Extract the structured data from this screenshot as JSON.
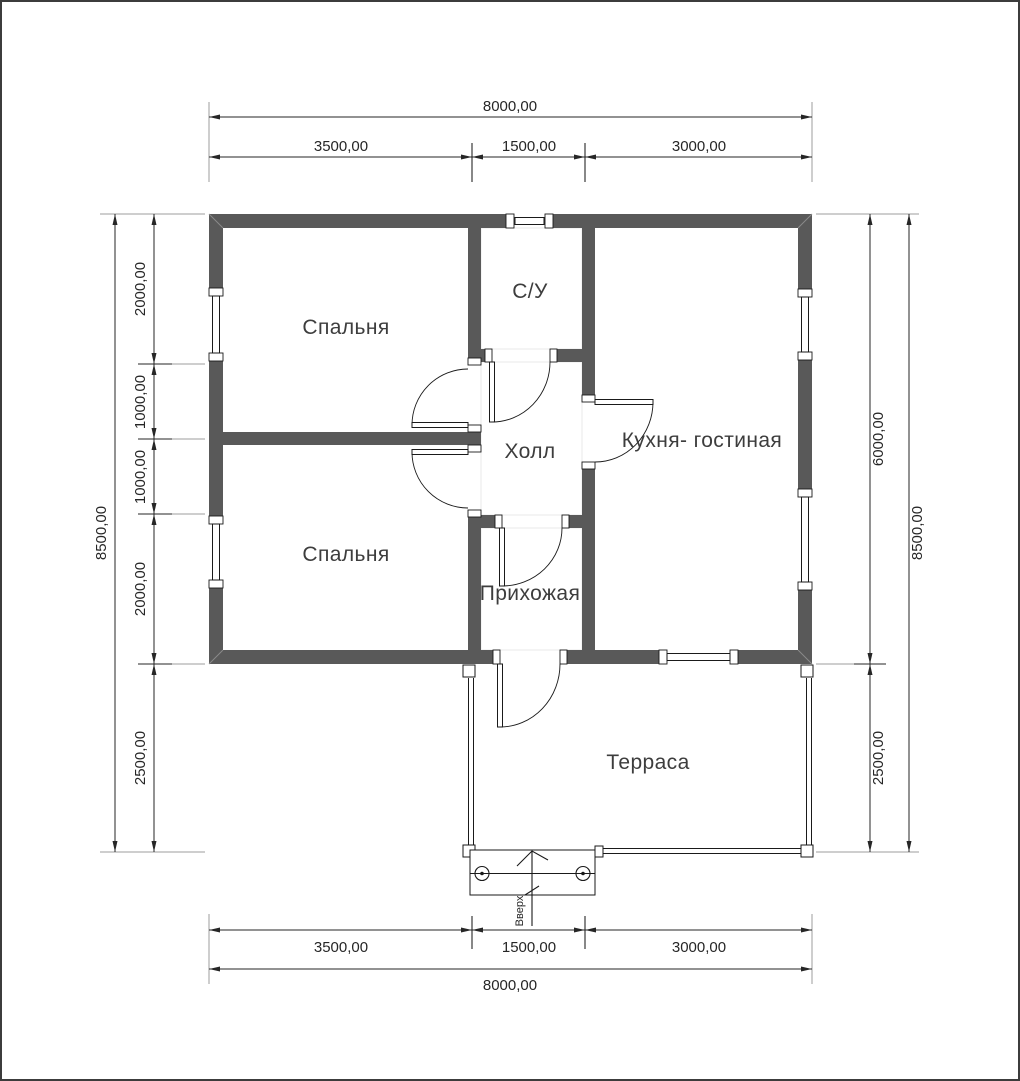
{
  "title": "Floor plan",
  "colors": {
    "wall": "#595959",
    "line": "#1a1a1a",
    "dim_text": "#262626",
    "room_text": "#3d3d3d",
    "witness": "#9d9d9d",
    "background": "#ffffff",
    "border": "#3c3c3c"
  },
  "rooms": {
    "bedroom_top": "Спальня",
    "bathroom": "С/У",
    "hall": "Холл",
    "kitchen_living": "Кухня- гостиная",
    "bedroom_bottom": "Спальня",
    "entry": "Прихожая",
    "terrace": "Терраса"
  },
  "stairs": {
    "label": "Вверх"
  },
  "dimensions": {
    "top": {
      "overall": "8000,00",
      "segments": [
        "3500,00",
        "1500,00",
        "3000,00"
      ]
    },
    "bottom": {
      "overall": "8000,00",
      "segments": [
        "3500,00",
        "1500,00",
        "3000,00"
      ]
    },
    "left": {
      "overall": "8500,00",
      "segments": [
        "2000,00",
        "1000,00",
        "1000,00",
        "2000,00",
        "2500,00"
      ]
    },
    "right": {
      "overall": "8500,00",
      "segments": [
        "6000,00",
        "2500,00"
      ]
    }
  }
}
